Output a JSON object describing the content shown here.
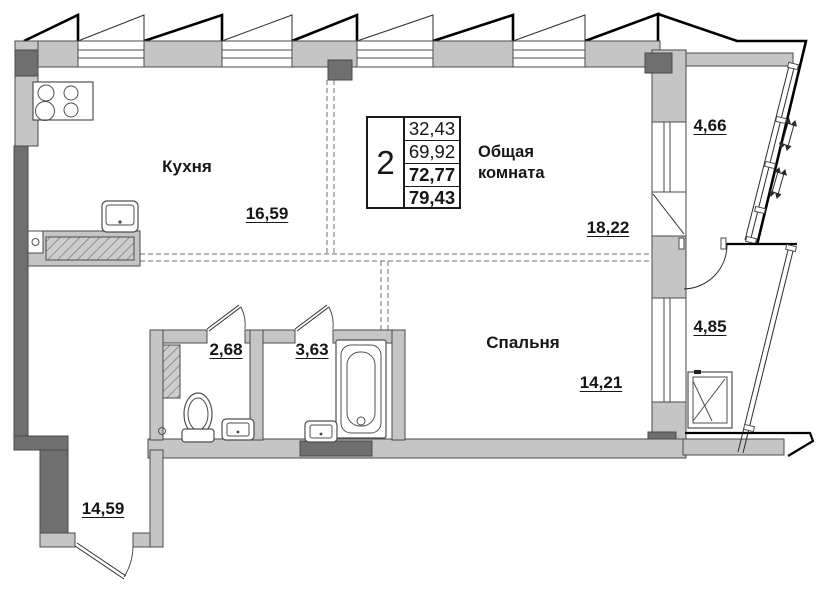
{
  "info_table": {
    "rooms_count": "2",
    "areas": [
      "32,43",
      "69,92",
      "72,77",
      "79,43"
    ]
  },
  "rooms": {
    "kitchen": {
      "name": "Кухня",
      "area": "16,59"
    },
    "living_room": {
      "name": "Общая комната",
      "area": "18,22"
    },
    "bedroom": {
      "name": "Спальня",
      "area": "14,21"
    },
    "wc": {
      "area": "2,68"
    },
    "bathroom": {
      "area": "3,63"
    },
    "balcony_upper": {
      "area": "4,66"
    },
    "balcony_lower": {
      "area": "4,85"
    },
    "hallway": {
      "area": "14,59"
    }
  },
  "colors": {
    "wall": "#c5c5c5",
    "column": "#6f6f6f",
    "edge": "#4a4a4a",
    "dash": "#8a8a8a",
    "outline": "#000000"
  }
}
